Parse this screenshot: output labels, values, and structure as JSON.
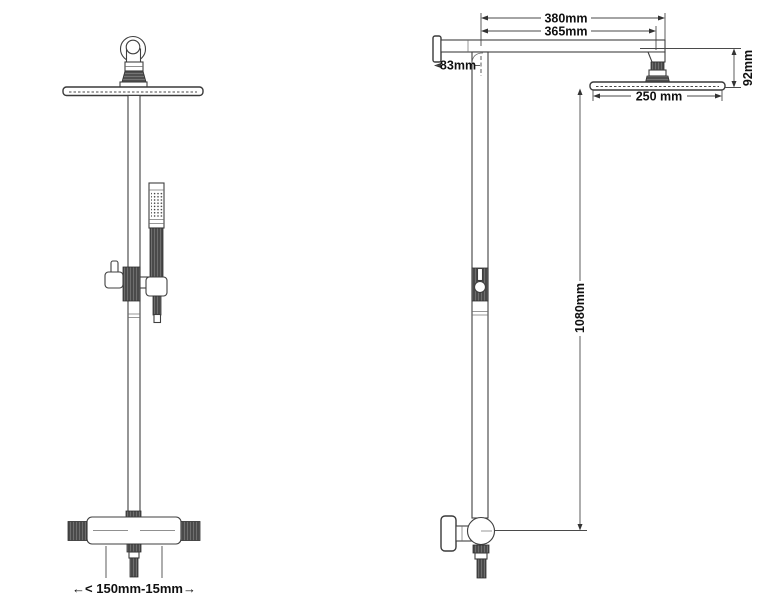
{
  "canvas": {
    "background": "#ffffff",
    "line_color": "#3f3f3f",
    "text_color": "#101010"
  },
  "dimensions": {
    "arm_length_total": "380mm",
    "arm_length_to_head": "365mm",
    "wall_to_column": "83mm",
    "head_drop_height": "92mm",
    "head_diameter": "250 mm",
    "column_height": "1080mm",
    "valve_connection_spacing": "←< 150mm-15mm→"
  }
}
